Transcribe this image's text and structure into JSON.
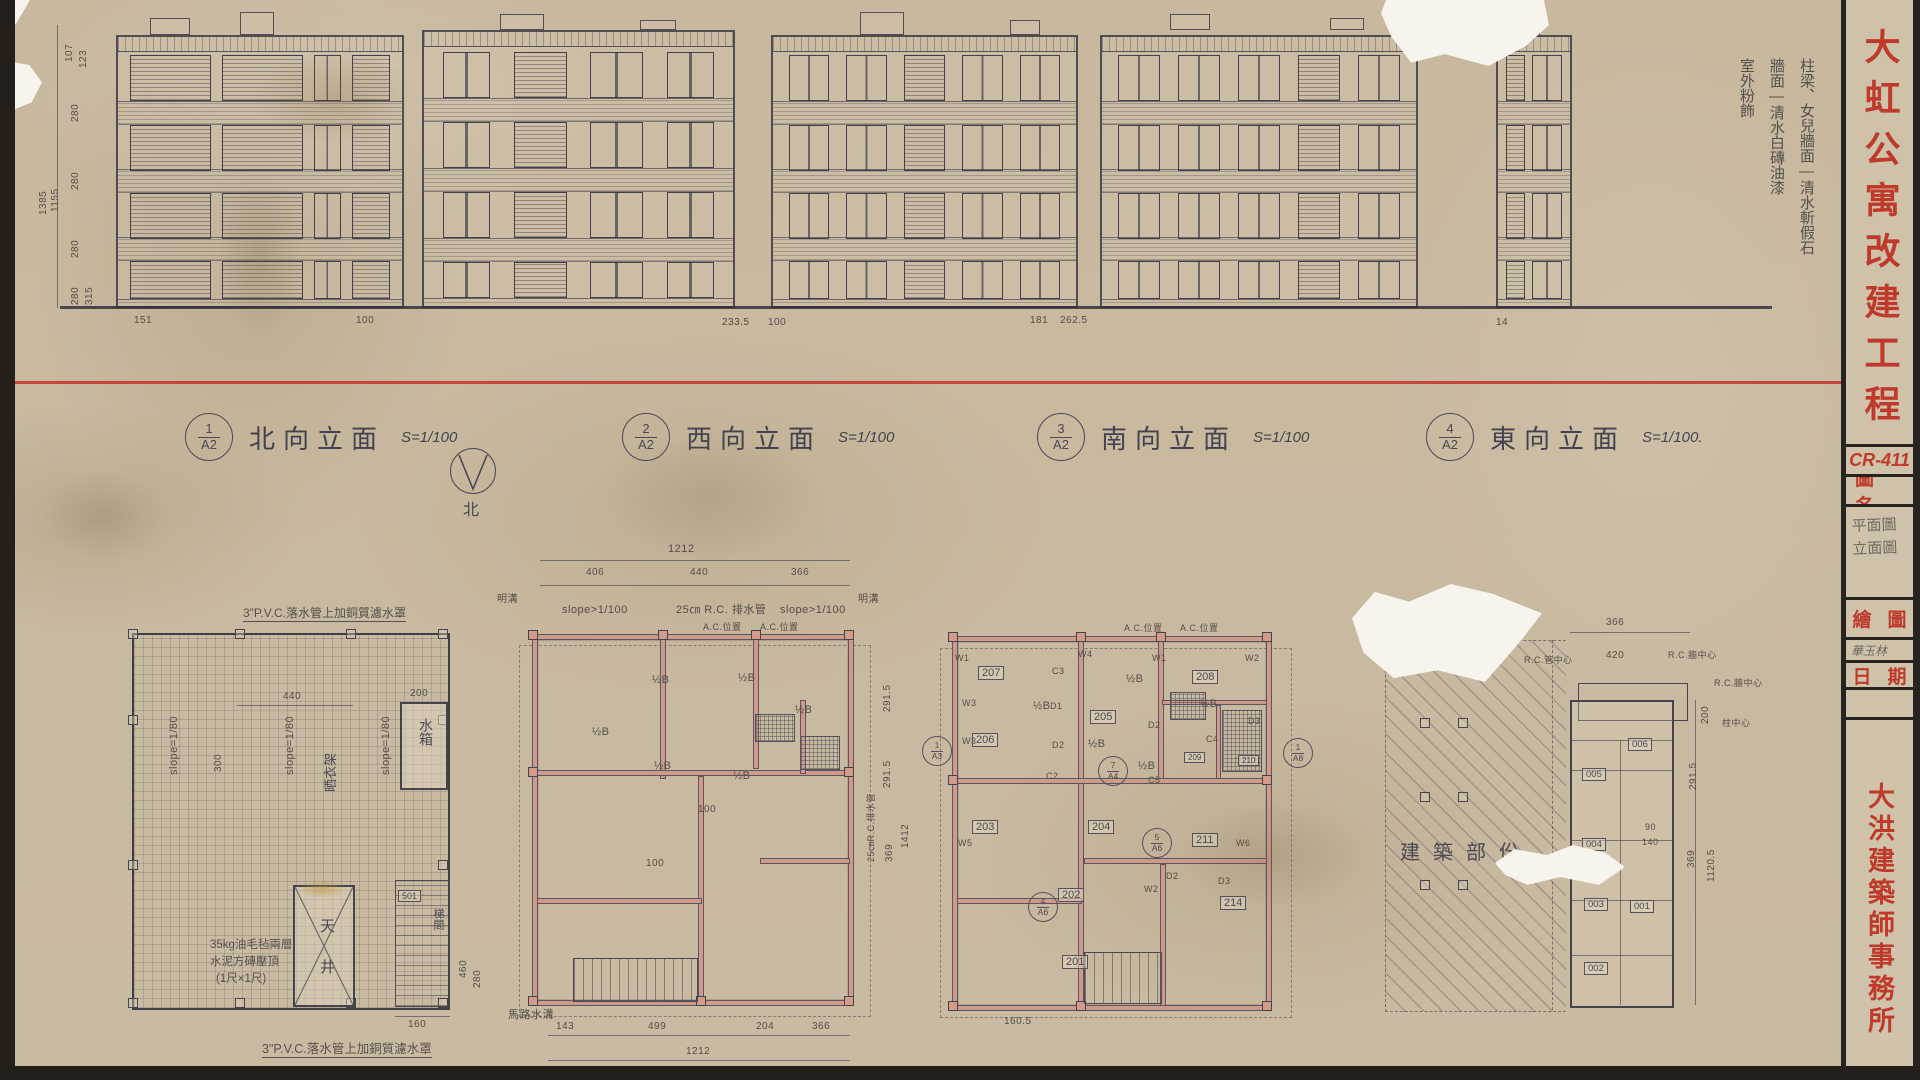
{
  "title_block": {
    "project_title": "大虹公寓改建工程",
    "sheet_no": "CR-411",
    "name_label": "圖名",
    "name_value_line1": "平面圖",
    "name_value_line2": "立面圖",
    "drawn_label": "繪圖",
    "drawn_value": "華玉林",
    "date_label": "日期",
    "firm": "大洪建築師事務所"
  },
  "finish_notes": [
    "柱梁、女兒牆面—清水斬假石",
    "牆面—清水白磚油漆",
    "室外粉飾"
  ],
  "elevations": [
    {
      "no": "1",
      "sheet": "A2",
      "name": "北向立面",
      "scale": "S=1/100"
    },
    {
      "no": "2",
      "sheet": "A2",
      "name": "西向立面",
      "scale": "S=1/100"
    },
    {
      "no": "3",
      "sheet": "A2",
      "name": "南向立面",
      "scale": "S=1/100"
    },
    {
      "no": "4",
      "sheet": "A2",
      "name": "東向立面",
      "scale": "S=1/100."
    }
  ],
  "left_dims": {
    "stack": [
      "107",
      "123",
      "280",
      "280",
      "280",
      "280",
      "315"
    ],
    "totals": [
      "1385",
      "1155"
    ]
  },
  "ground_dims": [
    "151",
    "100",
    "233.5",
    "100",
    "181",
    "262.5",
    "14"
  ],
  "compass_label": "北",
  "roof_plan": {
    "note_top": "3\"P.V.C.落水管上加銅質濾水罩",
    "note_bottom": "3\"P.V.C.落水管上加銅質濾水罩",
    "slope1": "slope=1/80",
    "slope2": "slope=1/80",
    "slope3": "slope=1/80",
    "dim_440": "440",
    "dim_200": "200",
    "dim_300": "300",
    "dim_160": "160",
    "dim_460": "460",
    "dim_280": "280",
    "water_tank": "水箱",
    "drying_rack": "晒衣架",
    "light_well": "天井",
    "stair_no": "501",
    "stair_label": "梯間",
    "paving_note_1": "35kg油毛毡兩層",
    "paving_note_2": "水泥方磚壓頂",
    "paving_note_3": "(1尺×1尺)"
  },
  "plan2": {
    "dim_total_top": "1212",
    "dims_top": [
      "406",
      "440",
      "366"
    ],
    "note_slope_l": "slope>1/100",
    "note_rc": "25㎝ R.C. 排水管",
    "note_slope_r": "slope>1/100",
    "ac_label": "A.C.位置",
    "drain_label": "明溝",
    "wall_label": "½B",
    "dim_100": "100",
    "dims_right": [
      "291.5",
      "291.5",
      "369"
    ],
    "dim_total_right": "1412",
    "rc_pipe_note": "25㎝R.C.排水管",
    "dims_bottom": [
      "143",
      "499",
      "204",
      "366"
    ],
    "dim_total_bottom": "1212",
    "road_note": "馬路水溝"
  },
  "plan3": {
    "rooms": [
      "207",
      "205",
      "208",
      "206",
      "203",
      "204",
      "211",
      "202",
      "201",
      "214",
      "209",
      "210"
    ],
    "ac_label": "A.C.位置",
    "wall_label": "½B",
    "marks": [
      "W1",
      "W4",
      "W1",
      "W2",
      "W3",
      "W3",
      "W5",
      "W6",
      "D1",
      "D2",
      "D2",
      "D3",
      "C3",
      "C2",
      "C4",
      "C5",
      "D2",
      "D3",
      "W2"
    ],
    "refs": [
      {
        "n": "1",
        "s": "A8"
      },
      {
        "n": "5",
        "s": "A6"
      },
      {
        "n": "4",
        "s": "A6"
      },
      {
        "n": "7",
        "s": "A4"
      },
      {
        "n": "1",
        "s": "A3"
      }
    ],
    "dim_bottom": "160.5"
  },
  "plan4": {
    "area_label": "建築部份",
    "rooms": [
      "006",
      "005",
      "004",
      "003",
      "001",
      "002"
    ],
    "dim_366": "366",
    "dim_420": "420",
    "note_rc_pipe": "R.C.管中心",
    "note_rc_wall_1": "R.C.牆中心",
    "note_rc_wall_2": "R.C.牆中心",
    "note_col": "柱中心",
    "dim_200": "200",
    "dim_2915": "291.5",
    "dim_369": "369",
    "dim_total": "1120.5",
    "dim_90": "90",
    "dim_140": "140"
  }
}
